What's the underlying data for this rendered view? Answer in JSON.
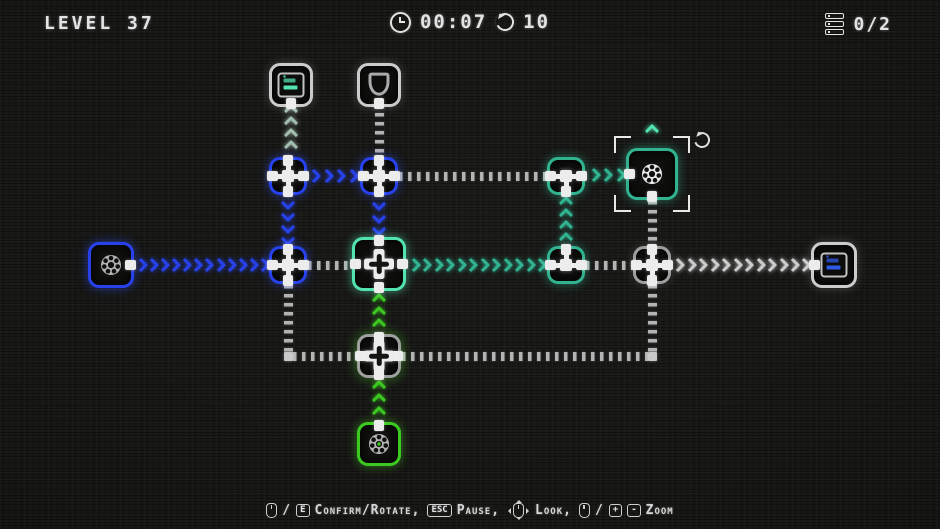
{
  "hud": {
    "level_label": "LEVEL 37",
    "timer": "00:07",
    "rotations": "10",
    "progress": "0/2"
  },
  "footer": {
    "hint_parts": [
      {
        "tokens": [
          {
            "t": "mouse"
          },
          {
            "t": "text",
            "v": "/"
          },
          {
            "t": "key",
            "v": "E"
          }
        ],
        "label": "Confirm/Rotate,"
      },
      {
        "tokens": [
          {
            "t": "key",
            "v": "ESC"
          }
        ],
        "label": "Pause,"
      },
      {
        "tokens": [
          {
            "t": "mouse-look"
          }
        ],
        "label": "Look,"
      },
      {
        "tokens": [
          {
            "t": "mouse"
          },
          {
            "t": "text",
            "v": "/"
          },
          {
            "t": "key",
            "v": "+"
          },
          {
            "t": "key",
            "v": "-"
          }
        ],
        "label": "Zoom"
      }
    ]
  },
  "colors": {
    "blue": "#2742ea",
    "teal": "#31b391",
    "teal_bright": "#52e3b0",
    "green": "#3cc921",
    "grey": "#9f9f9f",
    "grey_light": "#cccccc",
    "grey_teal": "#a3bfb0",
    "white": "#ededed",
    "dash_grey": "#b4b4b4",
    "bg": "#161614"
  },
  "puzzle": {
    "nodes": [
      {
        "id": "sink-teal-server",
        "x": 291,
        "y": 85,
        "size": 44,
        "border": "grey_light",
        "icon": "server",
        "icon_color": "teal",
        "tabs": [
          "down"
        ]
      },
      {
        "id": "sink-shield",
        "x": 379,
        "y": 85,
        "size": 44,
        "border": "grey_light",
        "icon": "shield",
        "tabs": [
          "down"
        ]
      },
      {
        "id": "connector-1",
        "x": 288,
        "y": 176,
        "size": 38,
        "border": "blue",
        "icon": "square",
        "tabs": [
          "up",
          "right",
          "down",
          "left"
        ]
      },
      {
        "id": "connector-2",
        "x": 379,
        "y": 176,
        "size": 38,
        "border": "blue",
        "icon": "square",
        "tabs": [
          "up",
          "right",
          "down",
          "left"
        ]
      },
      {
        "id": "connector-3",
        "x": 566,
        "y": 176,
        "size": 38,
        "border": "teal",
        "icon": "square",
        "tabs": [
          "left",
          "right",
          "down"
        ]
      },
      {
        "id": "machine-gear-selected",
        "x": 652,
        "y": 174,
        "size": 52,
        "border": "teal",
        "icon": "gear",
        "icon_color": "white",
        "tabs": [
          "left",
          "down"
        ],
        "selected": true
      },
      {
        "id": "source-gear-blue",
        "x": 111,
        "y": 265,
        "size": 46,
        "border": "blue",
        "icon": "gear",
        "icon_color": "grey",
        "tabs": [
          "right"
        ]
      },
      {
        "id": "connector-4",
        "x": 288,
        "y": 265,
        "size": 38,
        "border": "blue",
        "icon": "square",
        "tabs": [
          "up",
          "right",
          "down",
          "left"
        ]
      },
      {
        "id": "mixer-plus",
        "x": 379,
        "y": 264,
        "size": 54,
        "border": "teal_bright",
        "icon": "plus",
        "tabs": [
          "up",
          "right",
          "down",
          "left"
        ]
      },
      {
        "id": "connector-5",
        "x": 566,
        "y": 265,
        "size": 38,
        "border": "teal",
        "icon": "square",
        "tabs": [
          "left",
          "up",
          "right"
        ]
      },
      {
        "id": "connector-6",
        "x": 652,
        "y": 265,
        "size": 38,
        "border": "grey",
        "icon": "square",
        "tabs": [
          "up",
          "right",
          "down",
          "left"
        ]
      },
      {
        "id": "sink-blue-server",
        "x": 834,
        "y": 265,
        "size": 46,
        "border": "grey_light",
        "icon": "server",
        "icon_color": "blue",
        "tabs": [
          "left"
        ]
      },
      {
        "id": "junction-plus",
        "x": 379,
        "y": 356,
        "size": 44,
        "border": "grey",
        "icon": "plus",
        "tabs": [
          "up",
          "right",
          "down",
          "left"
        ],
        "glow": "green"
      },
      {
        "id": "source-gear-green",
        "x": 379,
        "y": 444,
        "size": 44,
        "border": "green",
        "icon": "gear",
        "icon_color": "green",
        "tabs": [
          "up"
        ]
      }
    ],
    "segments": [
      {
        "x": 291,
        "y": 104,
        "len": 50,
        "orient": "v",
        "style": "chev",
        "dir": "up",
        "color": "grey_teal"
      },
      {
        "x": 379,
        "y": 104,
        "len": 50,
        "orient": "v",
        "style": "dash",
        "color": "dash_grey"
      },
      {
        "x": 307,
        "y": 176,
        "len": 52,
        "orient": "h",
        "style": "chev",
        "dir": "right",
        "color": "blue"
      },
      {
        "x": 399,
        "y": 176,
        "len": 148,
        "orient": "h",
        "style": "dash",
        "color": "dash_grey"
      },
      {
        "x": 586,
        "y": 175,
        "len": 40,
        "orient": "h",
        "style": "chev",
        "dir": "right",
        "color": "teal"
      },
      {
        "x": 288,
        "y": 196,
        "len": 50,
        "orient": "v",
        "style": "chev",
        "dir": "down",
        "color": "blue"
      },
      {
        "x": 379,
        "y": 196,
        "len": 41,
        "orient": "v",
        "style": "chev",
        "dir": "down",
        "color": "blue"
      },
      {
        "x": 566,
        "y": 196,
        "len": 50,
        "orient": "v",
        "style": "chev",
        "dir": "up",
        "color": "teal"
      },
      {
        "x": 652,
        "y": 201,
        "len": 45,
        "orient": "v",
        "style": "dash",
        "color": "dash_grey"
      },
      {
        "x": 135,
        "y": 265,
        "len": 134,
        "orient": "h",
        "style": "chev",
        "dir": "right",
        "color": "blue"
      },
      {
        "x": 308,
        "y": 265,
        "len": 44,
        "orient": "h",
        "style": "dash",
        "color": "dash_grey"
      },
      {
        "x": 407,
        "y": 265,
        "len": 140,
        "orient": "h",
        "style": "chev",
        "dir": "right",
        "color": "teal"
      },
      {
        "x": 586,
        "y": 265,
        "len": 47,
        "orient": "h",
        "style": "dash",
        "color": "dash_grey"
      },
      {
        "x": 672,
        "y": 265,
        "len": 139,
        "orient": "h",
        "style": "chev",
        "dir": "right",
        "color": "grey_light"
      },
      {
        "x": 288,
        "y": 285,
        "len": 68,
        "orient": "v",
        "style": "dash",
        "color": "dash_grey"
      },
      {
        "x": 293,
        "y": 356,
        "len": 64,
        "orient": "h",
        "style": "dash",
        "color": "dash_grey"
      },
      {
        "x": 402,
        "y": 356,
        "len": 246,
        "orient": "h",
        "style": "dash",
        "color": "dash_grey"
      },
      {
        "x": 652,
        "y": 285,
        "len": 67,
        "orient": "v",
        "style": "dash",
        "color": "dash_grey"
      },
      {
        "x": 379,
        "y": 292,
        "len": 41,
        "orient": "v",
        "style": "chev",
        "dir": "up",
        "color": "green"
      },
      {
        "x": 379,
        "y": 379,
        "len": 42,
        "orient": "v",
        "style": "chev",
        "dir": "up",
        "color": "green"
      }
    ],
    "corners": [
      {
        "x": 288,
        "y": 356
      },
      {
        "x": 652,
        "y": 356
      }
    ]
  }
}
